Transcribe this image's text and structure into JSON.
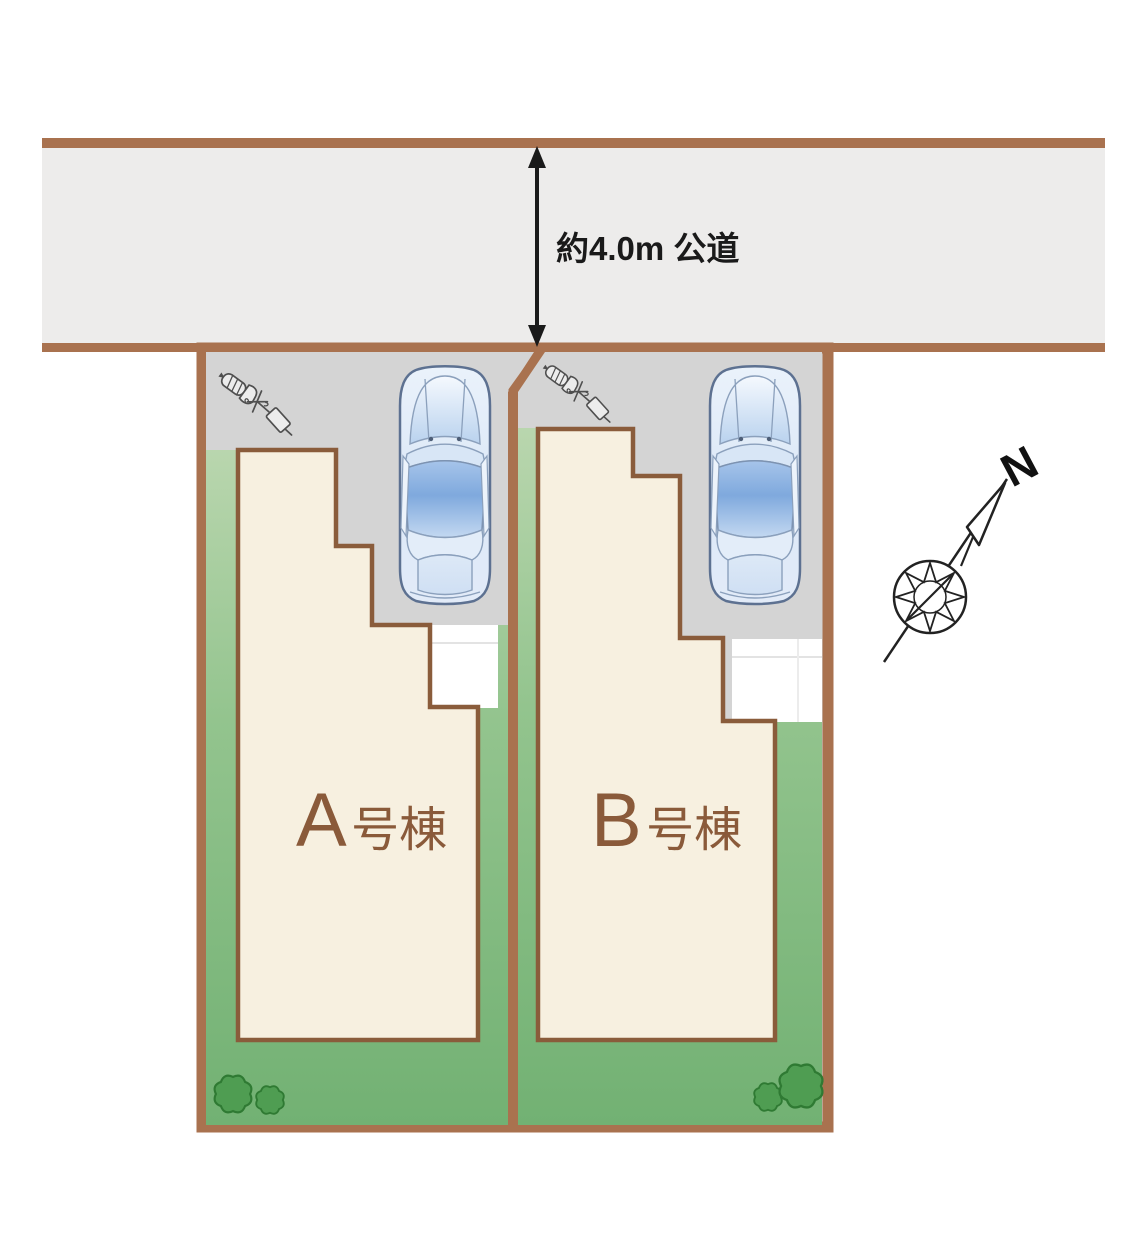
{
  "site_plan": {
    "road": {
      "width_label": "約4.0m 公道"
    },
    "compass": {
      "north_label": "N"
    },
    "lots": [
      {
        "id": "A",
        "label": "A号棟",
        "label_letter": "A",
        "label_suffix": "号棟",
        "features": [
          "driveway",
          "car",
          "utility-pole",
          "lawn",
          "porch",
          "bushes"
        ]
      },
      {
        "id": "B",
        "label": "B号棟",
        "label_letter": "B",
        "label_suffix": "号棟",
        "features": [
          "driveway",
          "car",
          "utility-pole",
          "lawn",
          "porch",
          "bushes"
        ]
      }
    ],
    "icons": {
      "car": "car-top-view",
      "utility_pole": "utility-pole",
      "compass": "compass-rose",
      "bush": "bush"
    },
    "colors": {
      "road_fill": "#edeceb",
      "boundary_brown": "#a9724f",
      "building_outline": "#8a5c3b",
      "building_fill": "#f7f0e0",
      "driveway_gray": "#d4d4d4",
      "lawn_green_light": "#b9d6ae",
      "lawn_green_dark": "#72b173",
      "bush_green": "#4f9d52",
      "bush_outline": "#2f7a33",
      "porch_white": "#ffffff",
      "label_brown": "#8a5a3a",
      "dimension_black": "#1a1a1a"
    }
  }
}
